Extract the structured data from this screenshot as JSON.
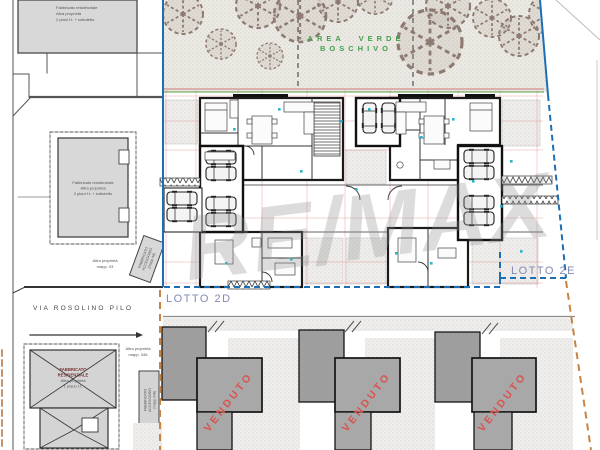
{
  "colors": {
    "boundary_blue": "#1d6fb5",
    "lot_label_blue": "#8289b5",
    "area_verde_green": "#44a04e",
    "venduto_red": "#d9534f",
    "orange_boundary": "#c98445",
    "building_gray": "#a8a8a8",
    "plan_dim_red": "#d46a6a",
    "marker_teal": "#2ab5c9"
  },
  "green_area": {
    "line1": "AREA VERDE",
    "line2": "BOSCHIVO"
  },
  "lots": {
    "lotto_2d": "LOTTO 2D",
    "lotto_2e": "LOTTO 2E"
  },
  "street": {
    "name": "VIA ROSOLINO PILO"
  },
  "sold_label": "VENDUTO",
  "watermark": "RE/MAX",
  "parcels": {
    "top_left": {
      "line1": "Fabbricato residenziale",
      "line2": "Altra proprietà",
      "line3": "2 piani f.t. + sottotetto"
    },
    "mid_left": {
      "line1": "Fabbricato residenziale",
      "line2": "Altra proprietà",
      "line3": "2 piani f.t. + sottotetto"
    },
    "mid_left_note": {
      "line1": "Altra proprietà",
      "line2": "mapp. 93"
    },
    "accessory_mid": {
      "line1": "FABBRICATO",
      "line2": "ACCESSORIO",
      "line3": "(mapp.46)"
    },
    "bottom_left_building": {
      "line1": "FABBRICATO",
      "line2": "RESIDENZIALE",
      "line3": "Altra proprietà",
      "line4": "1 piano f.t."
    },
    "bottom_left_note": {
      "line1": "Altra proprietà",
      "line2": "mapp. 346"
    },
    "accessory_bottom": {
      "line1": "FABBRICATO",
      "line2": "ACCESSORIO",
      "line3": "(mapp.348)"
    }
  }
}
